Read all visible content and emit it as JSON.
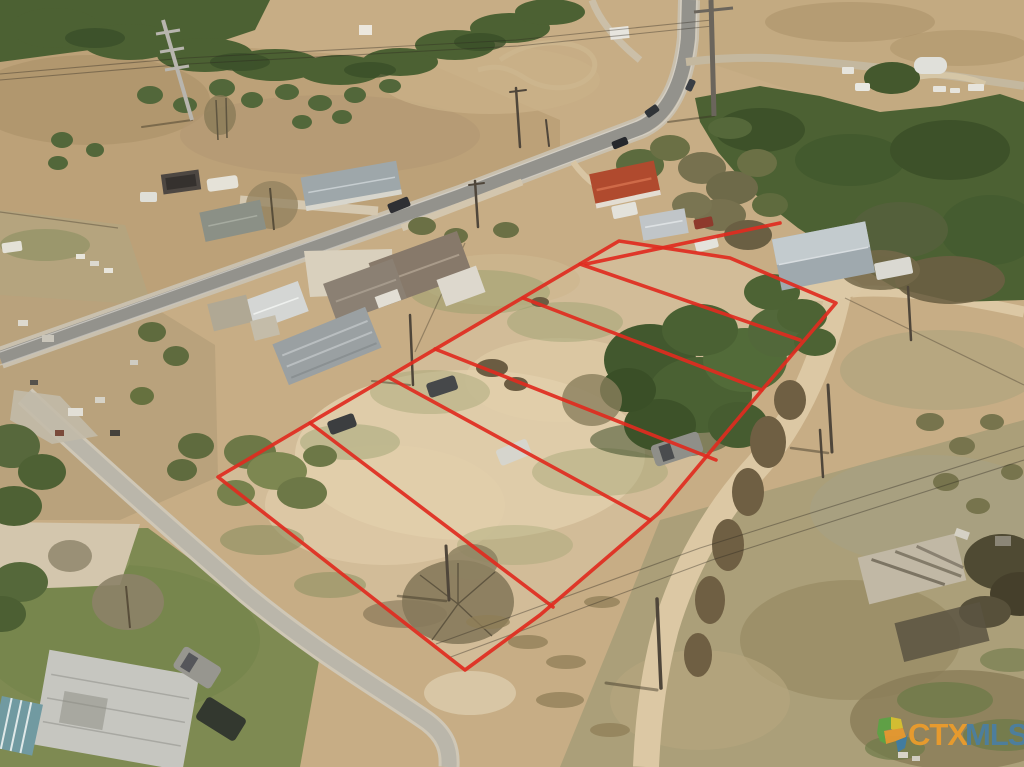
{
  "photo": {
    "kind": "aerial-drone-real-estate-photo",
    "width": 1024,
    "height": 767,
    "scene": "Aerial view of vacant land divided into lots outlined in red, beside a rural highway with houses, barns, dirt roads and scrub fields"
  },
  "watermark": {
    "ctx": "CTX",
    "mls": "MLS",
    "ctx_color": "#EE9D2B",
    "mls_color": "#4A7FA3",
    "logo_green": "#5BA345",
    "logo_orange": "#E8992F",
    "logo_blue": "#3E7CA6",
    "logo_yellow": "#D8C22F"
  },
  "overlay": {
    "color": "#E02B20",
    "lot_count": 6,
    "outer": "619,241 730,258 836,303 762,390 660,512 540,615 465,670 218,477",
    "spur": "586,264 780,223",
    "dividers": [
      "580,264 800,340",
      "523,298 762,390",
      "435,349 716,460",
      "388,377 650,520",
      "310,423 553,607"
    ]
  },
  "palette": {
    "dirt_base": "#c7ad85",
    "dirt_pale": "#e2cfab",
    "field_brown": "#b89e74",
    "grass_green": "#7e8a52",
    "forest_green": "#4c6133",
    "road_asphalt": "#93928c",
    "country_road": "#bab6aa",
    "dirt_track": "#dcc8a4",
    "red_roof": "#b04a2e",
    "metal_roof": "#9fa9ae"
  }
}
